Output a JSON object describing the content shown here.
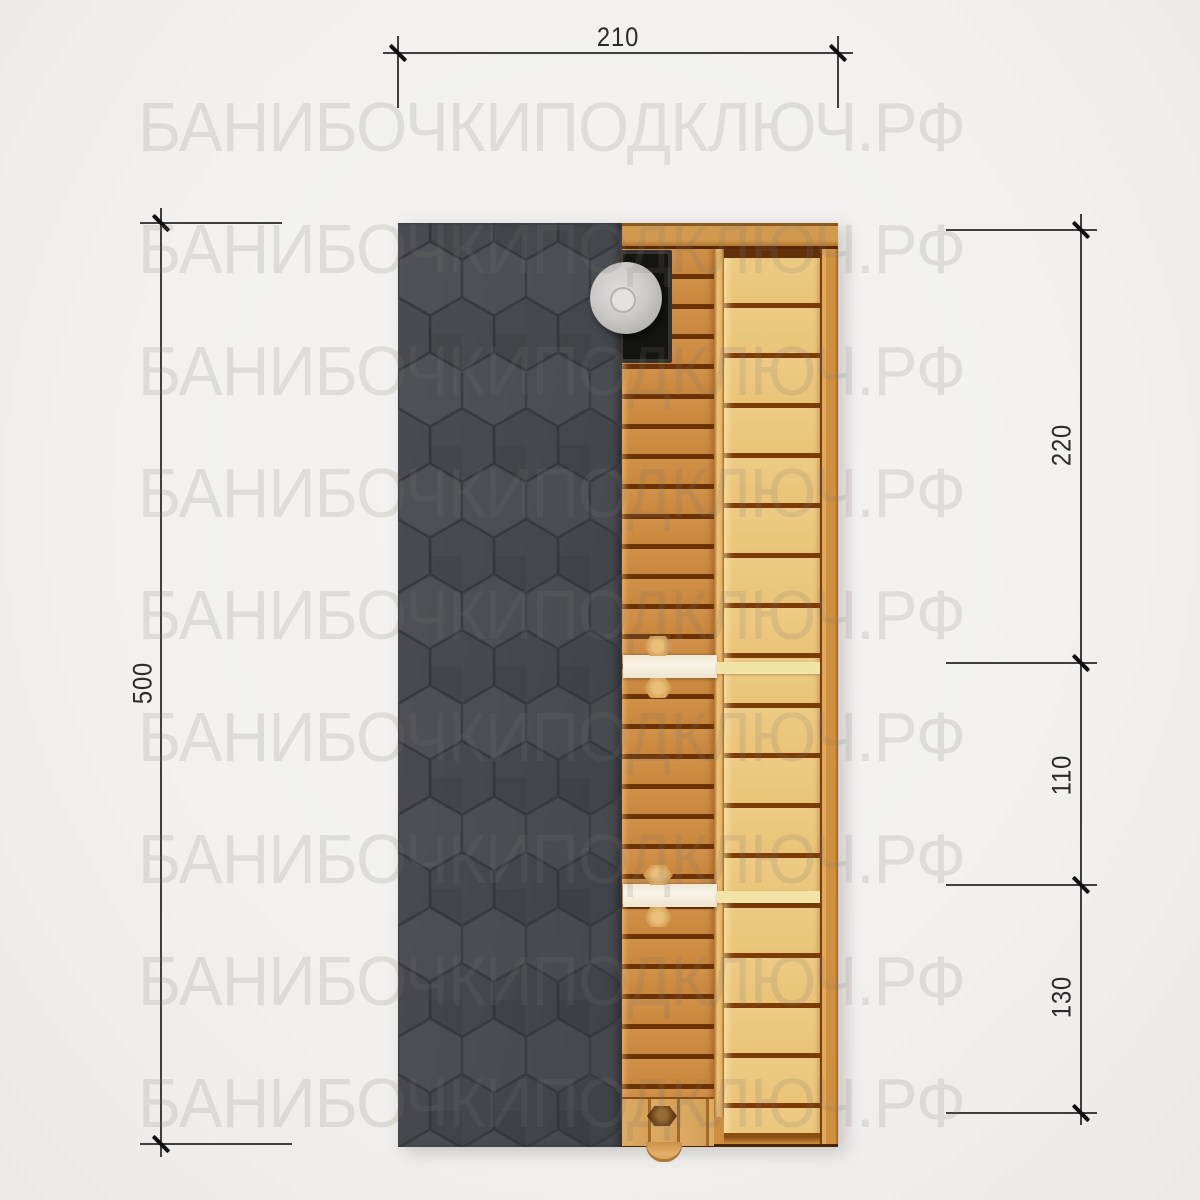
{
  "watermark": {
    "text": "БАНИБОЧКИПОДКЛЮЧ.РФ",
    "row_count": 9,
    "color": "#dfdedd"
  },
  "dimensions": {
    "top_width": {
      "label": "210"
    },
    "left_height": {
      "label": "500"
    },
    "right_segments": [
      {
        "label": "220"
      },
      {
        "label": "110"
      },
      {
        "label": "130"
      }
    ]
  },
  "drawing": {
    "type": "barrel-sauna-floor-plan",
    "parts": [
      "roof-shingles",
      "sauna-interior",
      "stove",
      "chimney-pipe",
      "floor-slats",
      "side-bench",
      "partition-wall",
      "door-handle",
      "entrance-door"
    ]
  },
  "colors": {
    "background": "#f2f1ef",
    "roof": "#45484d",
    "roof_line": "#34373c",
    "wood_floor": "#cd8c42",
    "wood_bench": "#ecca82",
    "wood_gap": "#6e3306",
    "stove": "#141412",
    "chimney": "#cccac8",
    "dimension_line": "#3f3f3f",
    "tick": "#101010",
    "watermark": "#dfdedd"
  }
}
